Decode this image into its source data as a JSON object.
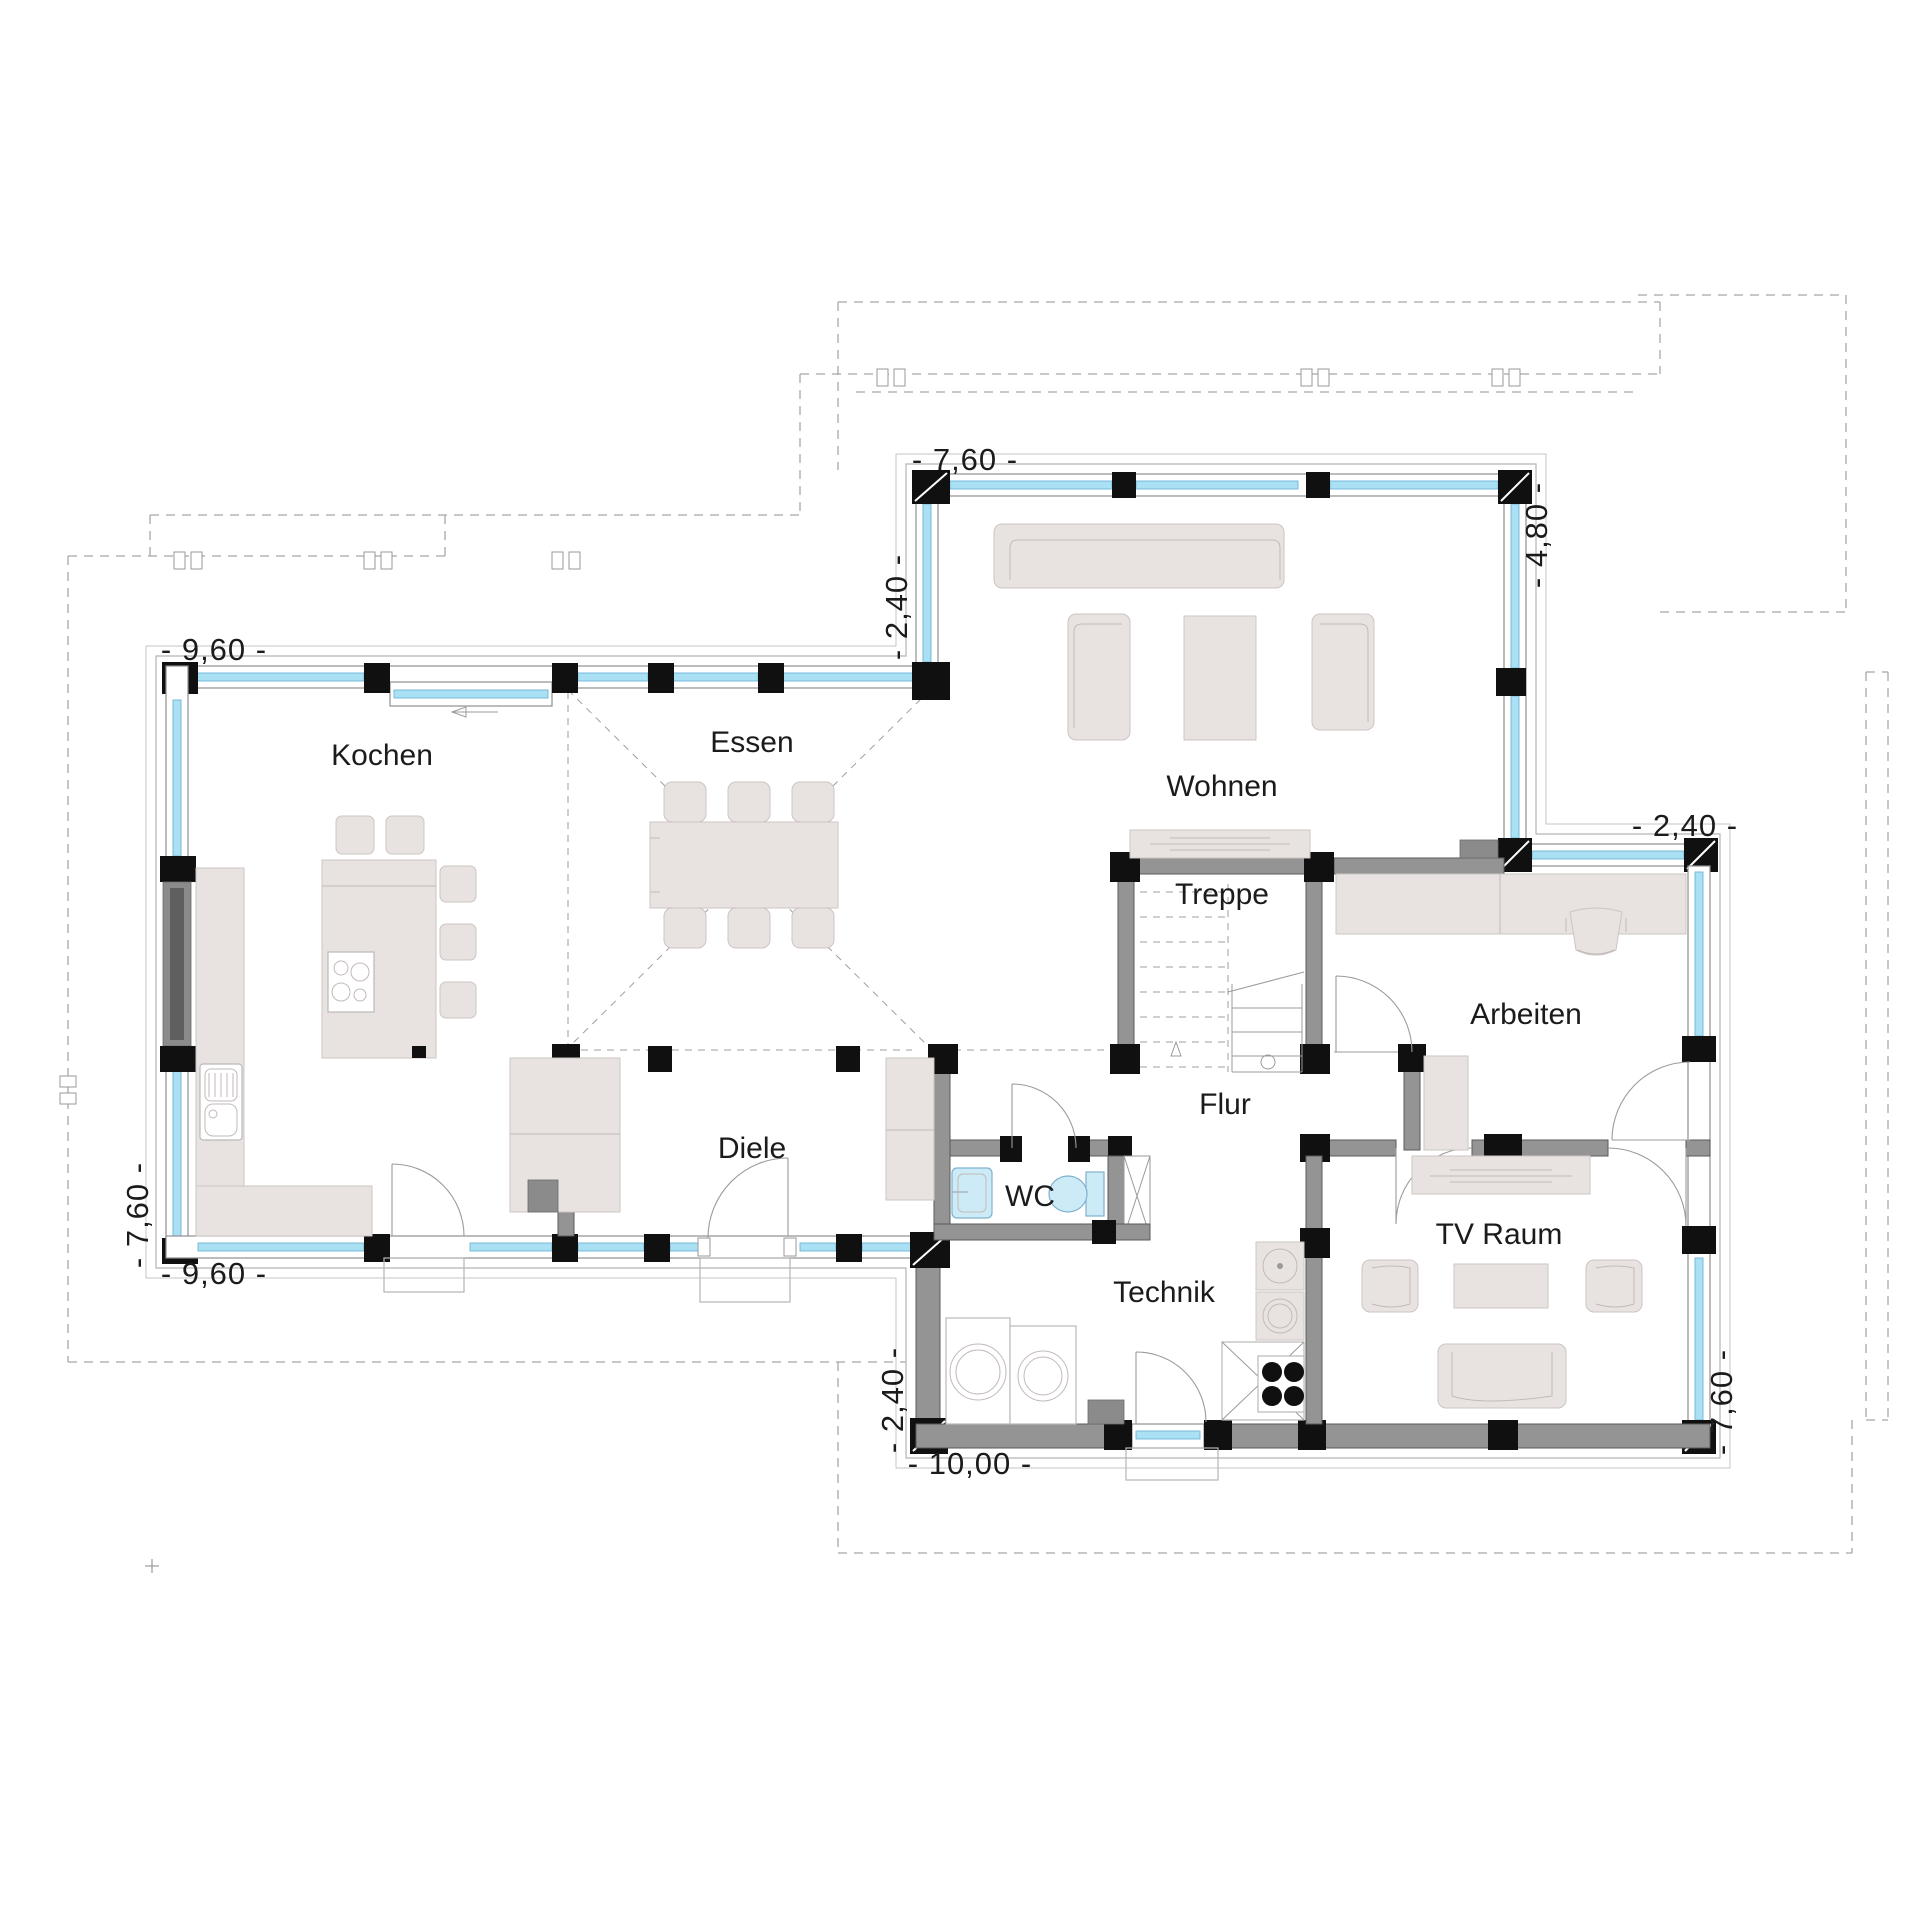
{
  "floor_plan": {
    "rooms": {
      "kochen": "Kochen",
      "essen": "Essen",
      "wohnen": "Wohnen",
      "treppe": "Treppe",
      "flur": "Flur",
      "arbeiten": "Arbeiten",
      "diele": "Diele",
      "wc": "WC",
      "technik": "Technik",
      "tv_raum": "TV Raum"
    },
    "dimensions": {
      "kochen_top": "- 9,60 -",
      "wohnen_top": "- 7,60 -",
      "wohnen_left": "- 2,40 -",
      "wohnen_right": "- 4,80 -",
      "arbeiten_top": "- 2,40 -",
      "tv_right": "- 7,60 -",
      "technik_bottom": "- 10,00 -",
      "technik_left": "- 2,40 -",
      "kochen_bottom": "- 9,60 -",
      "kochen_left": "- 7,60 -"
    },
    "colors": {
      "glazing": "#a9e0f4",
      "interior_wall": "#949494",
      "post": "#101010",
      "furniture": "#e8e3e1",
      "fixture": "#cdeaf7"
    }
  }
}
